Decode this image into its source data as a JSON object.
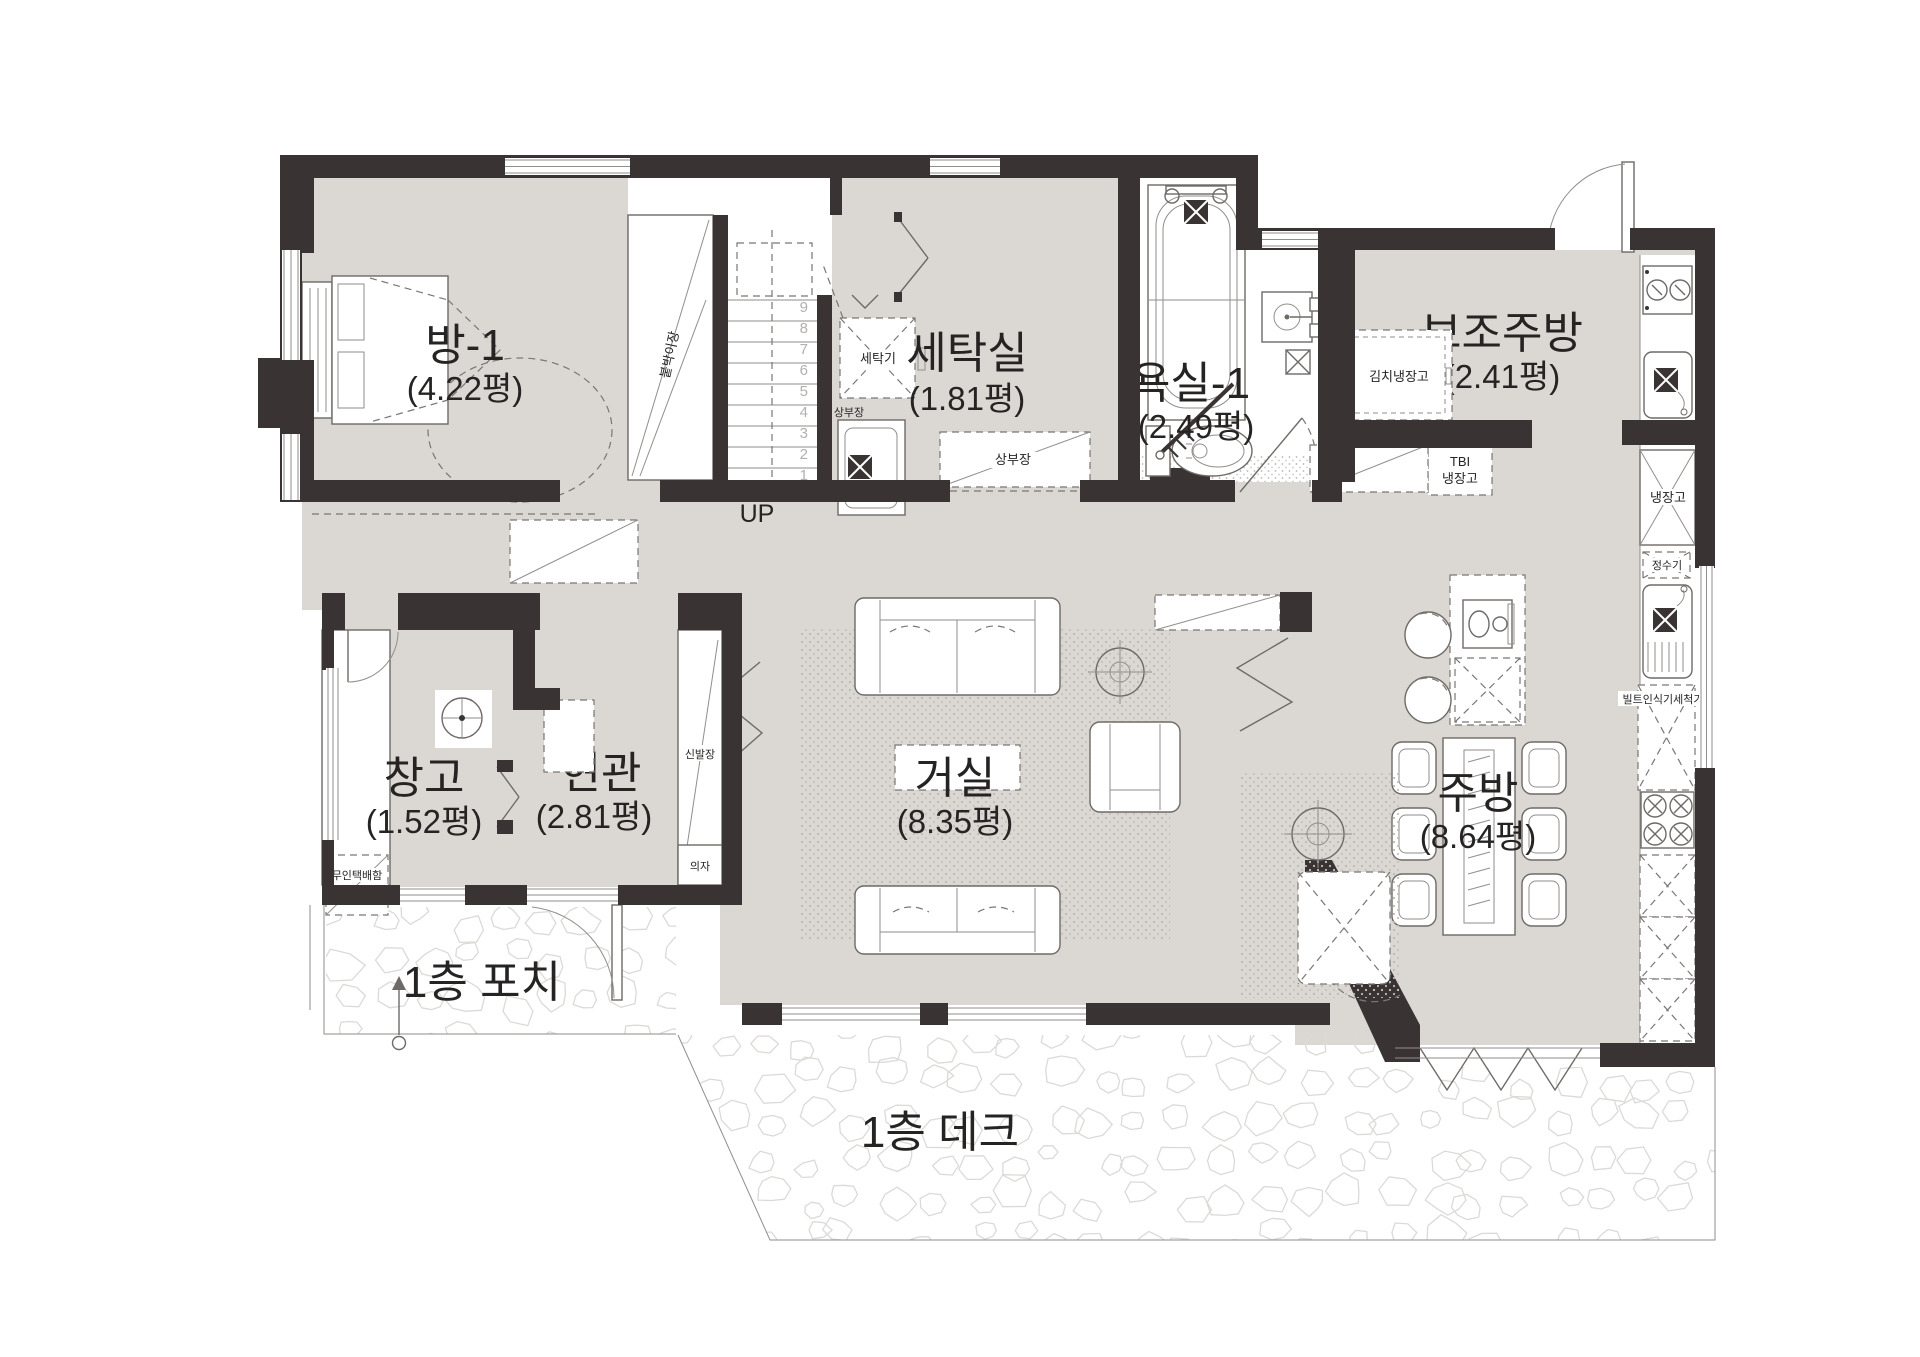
{
  "plan": {
    "floor_type": "floor-plan",
    "rooms": [
      {
        "id": "room1",
        "name": "방-1",
        "area": "(4.22평)"
      },
      {
        "id": "laundry",
        "name": "세탁실",
        "area": "(1.81평)"
      },
      {
        "id": "bath1",
        "name": "욕실-1",
        "area": "(2.49평)"
      },
      {
        "id": "auxkitchen",
        "name": "보조주방",
        "area": "(2.41평)"
      },
      {
        "id": "storage",
        "name": "창고",
        "area": "(1.52평)"
      },
      {
        "id": "entrance",
        "name": "현관",
        "area": "(2.81평)"
      },
      {
        "id": "living",
        "name": "거실",
        "area": "(8.35평)"
      },
      {
        "id": "kitchen",
        "name": "주방",
        "area": "(8.64평)"
      }
    ],
    "outdoor": {
      "porch": "1층 포치",
      "deck": "1층 데크"
    },
    "stairs": {
      "up_label": "UP",
      "numbers": [
        "9",
        "8",
        "7",
        "6",
        "5",
        "4",
        "3",
        "2",
        "1"
      ]
    },
    "fixtures": {
      "closet": "붙박이장",
      "washer": "세탁기",
      "upper_cabinet": "상부장",
      "upper_cabinet2": "상부장",
      "kimchi_fridge": "김치냉장고",
      "tbi_line1": "TBI",
      "tbi_line2": "냉장고",
      "fridge": "냉장고",
      "water_purifier": "정수기",
      "dishwasher": "빌트인식기세척기",
      "shoe_cabinet": "신발장",
      "bench": "의자",
      "parcel_box": "무인택배함"
    },
    "colors": {
      "wall": "#3a3334",
      "floor": "#dbd7d3",
      "line": "#6e6a67",
      "stair_number": "#b3b0ae",
      "text": "#262423"
    }
  }
}
